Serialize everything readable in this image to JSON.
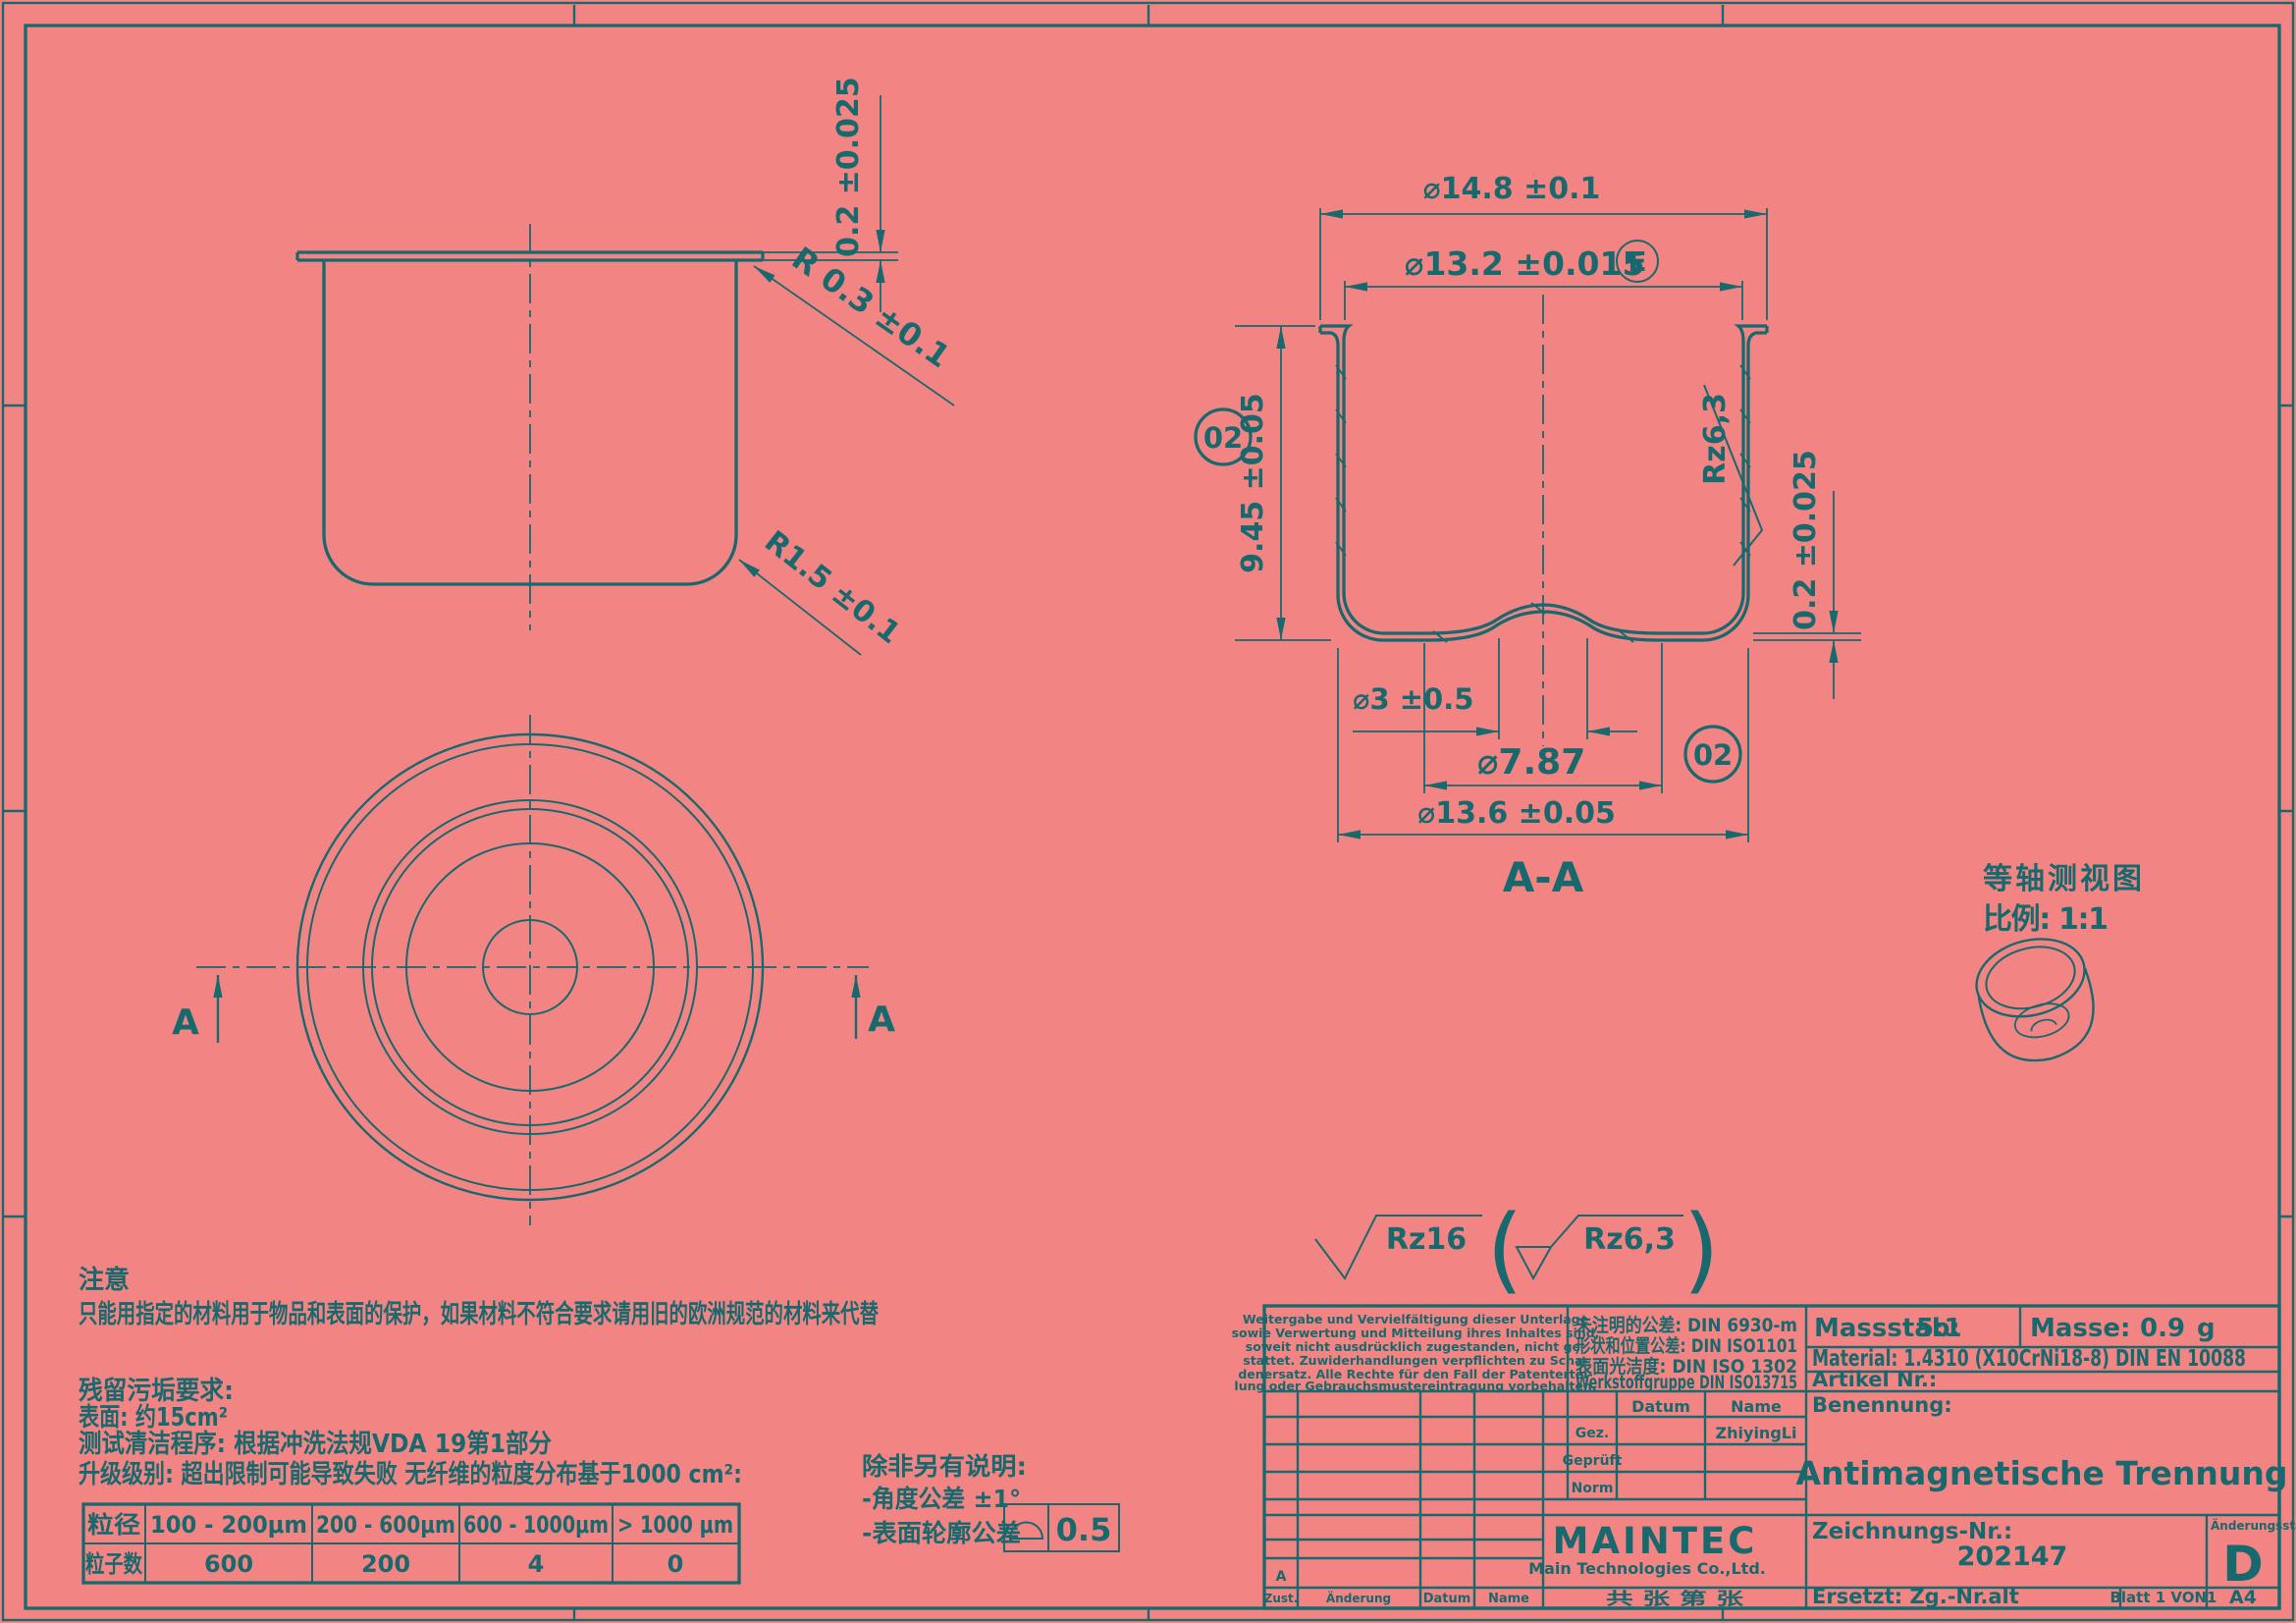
{
  "colors": {
    "background": "#F28583",
    "line": "#17696D"
  },
  "front_view": {
    "dim_flange_thickness": "0.2 ±0.025",
    "dim_corner_radius": "R 0.3 ±0.1",
    "dim_bottom_radius": "R1.5 ±0.1"
  },
  "top_view": {
    "section_label_left": "A",
    "section_label_right": "A"
  },
  "section_view": {
    "dim_outer_flange": "⌀14.8 ±0.1",
    "dim_inner_diameter": "⌀13.2 ±0.015",
    "envelope_symbol": "E",
    "dim_height": "9.45 ±0.05",
    "roughness_inner": "Rz6,3",
    "dim_bottom_thickness": "0.2 ±0.025",
    "dim_center_dome": "⌀3 ±0.5",
    "dim_dome_base": "⌀7.87",
    "dim_outer_body": "⌀13.6 ±0.05",
    "balloon_left": "02",
    "balloon_bottom": "02",
    "label": "A-A"
  },
  "iso_view": {
    "title": "等轴测视图",
    "scale": "比例: 1:1"
  },
  "roughness_note": {
    "general": "Rz16",
    "paren_open": "(",
    "alternative": "Rz6,3",
    "paren_close": ")"
  },
  "notes": {
    "caution_title": "注意",
    "caution_text": "只能用指定的材料用于物品和表面的保护，如果材料不符合要求请用旧的欧洲规范的材料来代替",
    "residue_title": "残留污垢要求:",
    "surface_line": "表面: 约15cm²",
    "procedure_line": "测试清洁程序: 根据冲洗法规VDA 19第1部分",
    "grade_line": "升级级别: 超出限制可能导致失败 无纤维的粒度分布基于1000 cm²:"
  },
  "particle_table": {
    "size_label": "粒径",
    "headers": [
      "100 - 200μm",
      "200 - 600μm",
      "600 - 1000μm",
      "> 1000 μm"
    ],
    "count_label": "粒子数",
    "values": [
      "600",
      "200",
      "4",
      "0"
    ]
  },
  "unless_note": {
    "title": "除非另有说明:",
    "angle_line": "-角度公差 ±1°",
    "profile_line": "-表面轮廓公差",
    "profile_value": "0.5"
  },
  "title_block": {
    "legal_lines": [
      "Weitergabe und Vervielfältigung dieser Unterlage",
      "sowie Verwertung und Mitteilung ihres Inhaltes sind,",
      "soweit nicht ausdrücklich zugestanden, nicht ge-",
      "stattet. Zuwiderhandlungen verpflichten zu Scha-",
      "denersatz. Alle Rechte für den Fall der Patentertei-",
      "lung oder Gebrauchsmustereintragung vorbehalten."
    ],
    "tolerance_lines": [
      "未注明的公差: DIN 6930-m",
      "形状和位置公差: DIN ISO1101",
      "表面光洁度: DIN ISO 1302",
      "Werkstoffgruppe DIN ISO13715"
    ],
    "scale_label": "Massstab:",
    "scale_value": "5:1",
    "mass_label": "Masse:",
    "mass_value": "0.9",
    "mass_unit": "g",
    "material": "Material: 1.4310 (X10CrNi18-8) DIN EN 10088",
    "article_label": "Artikel Nr.:",
    "name_label": "Benennung:",
    "part_name": "Antimagnetische Trennung",
    "drawing_no_label": "Zeichnungs-Nr.:",
    "drawing_no": "202147",
    "revision_label": "Änderungsstand",
    "revision": "D",
    "replaces": "Ersetzt: Zg.-Nr.alt",
    "sheet": "Blatt 1 VON1",
    "format": "A4",
    "grid": {
      "datum": "Datum",
      "name": "Name",
      "gez": "Gez.",
      "geprueft": "Geprüft",
      "norm": "Norm",
      "drawn_by": "ZhiyingLi",
      "rev_a": "A"
    },
    "bottom_row": {
      "zust": "Zust.",
      "aenderung": "Änderung",
      "datum": "Datum",
      "name": "Name",
      "pages": "共 张 第 张"
    },
    "company": {
      "logo": "MAINTEC",
      "name": "Main Technologies Co.,Ltd."
    }
  }
}
